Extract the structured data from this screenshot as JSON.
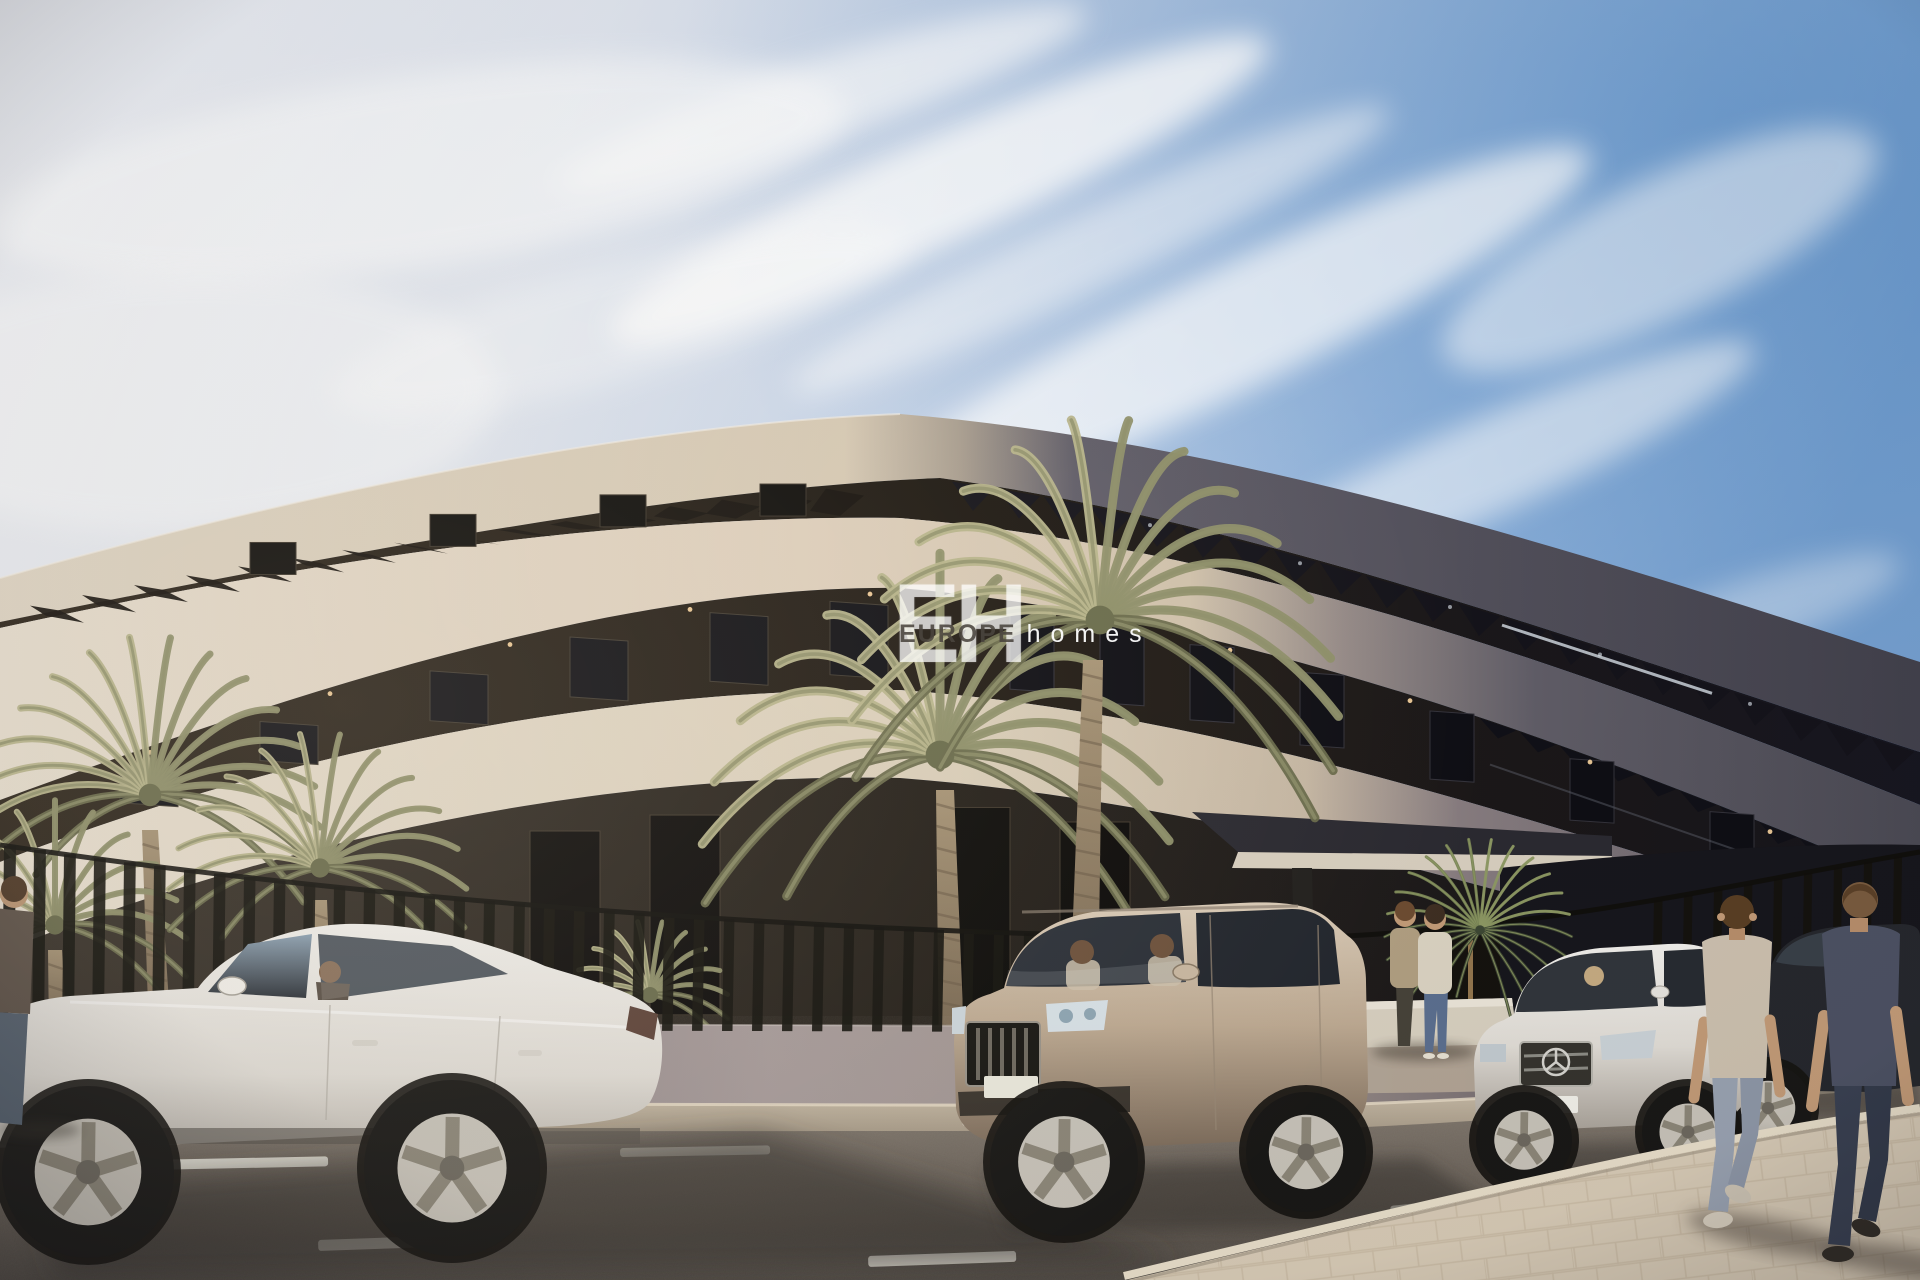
{
  "meta": {
    "description": "Photorealistic 3D architectural rendering of a long curved modern apartment building on a sunny street, with date palm trees, a slatted street fence, parked cars (white sedan, champagne SUV, white Mercedes sedan, dark sedan), a couple at the entrance and two men walking away on a paved sidewalk under a blue sky with wispy clouds.",
    "style": "exterior real-estate visualization"
  },
  "watermark": {
    "initials": "EH",
    "brand_primary": "EUROPE",
    "brand_secondary": "homes"
  },
  "signage": {
    "wall_letters": "TO"
  },
  "palette": {
    "sky_left": "#edeff5",
    "sky_right": "#6f9cce",
    "cloud": "#ffffff",
    "facade_cream": "#ddd3c2",
    "facade_cream_deep": "#cdbfa9",
    "facade_shadow": "#57545e",
    "recess_dark": "#221c16",
    "ground_dark": "#241f19",
    "wall_mauve": "#a29897",
    "wall_shadow": "#6e6570",
    "fence": "#14120d",
    "road": "#7b7268",
    "road_shadow": "#4e4842",
    "sidewalk": "#d9ccb7",
    "paver_line": "#c1b299",
    "marking_white": "#f2efe4",
    "palm_light": "#b7b48b",
    "palm_mid": "#8f906a",
    "palm_dark": "#6a6c4c",
    "trunk": "#95846e",
    "car_white": "#f2f0ec",
    "car_champagne": "#c8b7a1",
    "car_silver": "#eceae6",
    "car_dark": "#26282d",
    "skin": "#c49c78",
    "tee_tan": "#cec2b0",
    "jeans_light": "#9aa3b2",
    "tee_slate": "#4d5264",
    "jeans_dark": "#3a4152"
  },
  "scene": {
    "objects": [
      "curved apartment building with cream balcony bands",
      "roof pergola slats",
      "shaded right wing of building",
      "entrance canopy",
      "street fence with vertical slats on low wall",
      "date palm trees",
      "white sedan with driver",
      "champagne SUV with two occupants",
      "white Mercedes sedan with driver",
      "dark sedan",
      "couple standing at entrance",
      "two men walking away",
      "asphalt road with white dashed markings",
      "paved foreground sidewalk",
      "wispy diagonal clouds"
    ]
  }
}
